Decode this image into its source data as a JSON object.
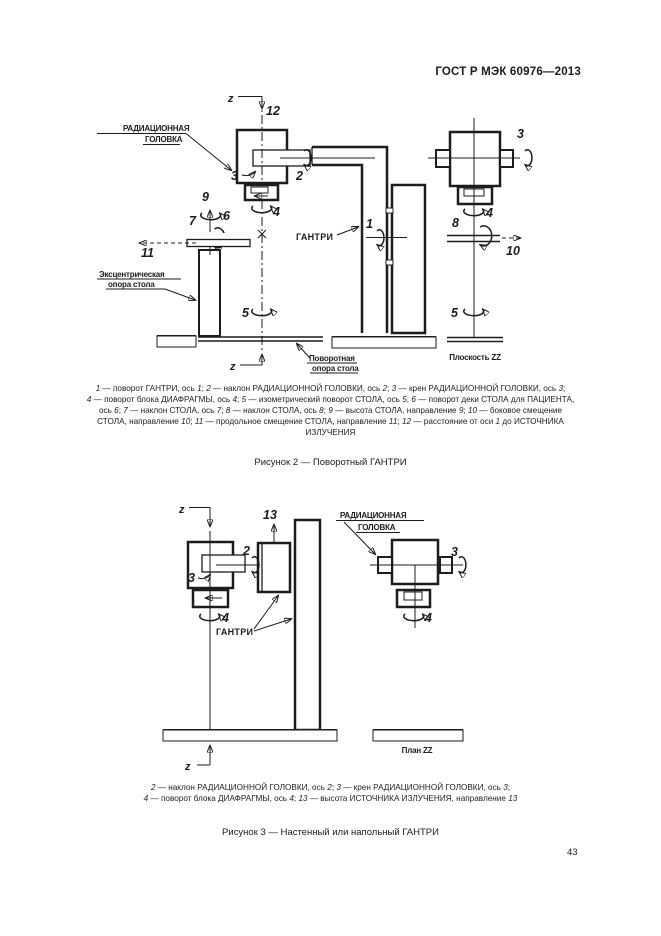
{
  "page": {
    "header": "ГОСТ Р МЭК 60976—2013",
    "page_number": "43"
  },
  "figure2": {
    "labels": {
      "z_top": "z",
      "dist12": "12",
      "rad_head_line1": "РАДИАЦИОННАЯ",
      "rad_head_line2": "ГОЛОВКА",
      "axis2": "2",
      "axis3": "3",
      "axis4": "4",
      "axis9": "9",
      "axis6": "6",
      "axis7": "7",
      "axis11": "11",
      "axis1": "1",
      "gantry": "ГАНТРИ",
      "eccentric_line1": "Эксцентрическая",
      "eccentric_line2": "опора стола",
      "axis5": "5",
      "z_bottom": "z",
      "rotary_line1": "Поворотная",
      "rotary_line2": "опора стола",
      "r_axis3": "3",
      "r_axis4": "4",
      "r_axis8": "8",
      "r_axis10": "10",
      "r_axis5": "5",
      "plane_zz": "Плоскость ZZ"
    },
    "caption_lines": [
      "1 — поворот ГАНТРИ, ось 1; 2 — наклон РАДИАЦИОННОЙ ГОЛОВКИ, ось 2; 3 — крен РАДИАЦИОННОЙ ГОЛОВКИ, ось 3;",
      "4 — поворот блока ДИАФРАГМЫ, ось 4; 5 — изометрический поворот СТОЛА, ось 5; 6 — поворот деки СТОЛА для ПАЦИЕНТА,",
      "ось 6; 7 — наклон СТОЛА, ось 7; 8 — наклон СТОЛА, ось 8; 9 — высота СТОЛА, направление 9; 10 — боковое смещение",
      "СТОЛА, направление 10; 11 — продольное смещение СТОЛА, направление 11; 12 — расстояние от оси 1 до ИСТОЧНИКА",
      "ИЗЛУЧЕНИЯ"
    ],
    "title": "Рисунок 2 — Поворотный ГАНТРИ"
  },
  "figure3": {
    "labels": {
      "z_top": "z",
      "dir13": "13",
      "axis2": "2",
      "axis3": "3",
      "axis4": "4",
      "gantry": "ГАНТРИ",
      "z_bottom": "z",
      "rad_head_line1": "РАДИАЦИОННАЯ",
      "rad_head_line2": "ГОЛОВКА",
      "r_axis3": "3",
      "r_axis4": "4",
      "plan_zz": "План ZZ"
    },
    "caption_lines": [
      "2 — наклон РАДИАЦИОННОЙ ГОЛОВКИ, ось 2; 3 — крен РАДИАЦИОННОЙ ГОЛОВКИ, ось 3;",
      "4 — поворот блока ДИАФРАГМЫ, ось 4; 13 — высота ИСТОЧНИКА ИЗЛУЧЕНИЯ, направление 13"
    ],
    "title": "Рисунок 3 — Настенный или напольный ГАНТРИ"
  }
}
